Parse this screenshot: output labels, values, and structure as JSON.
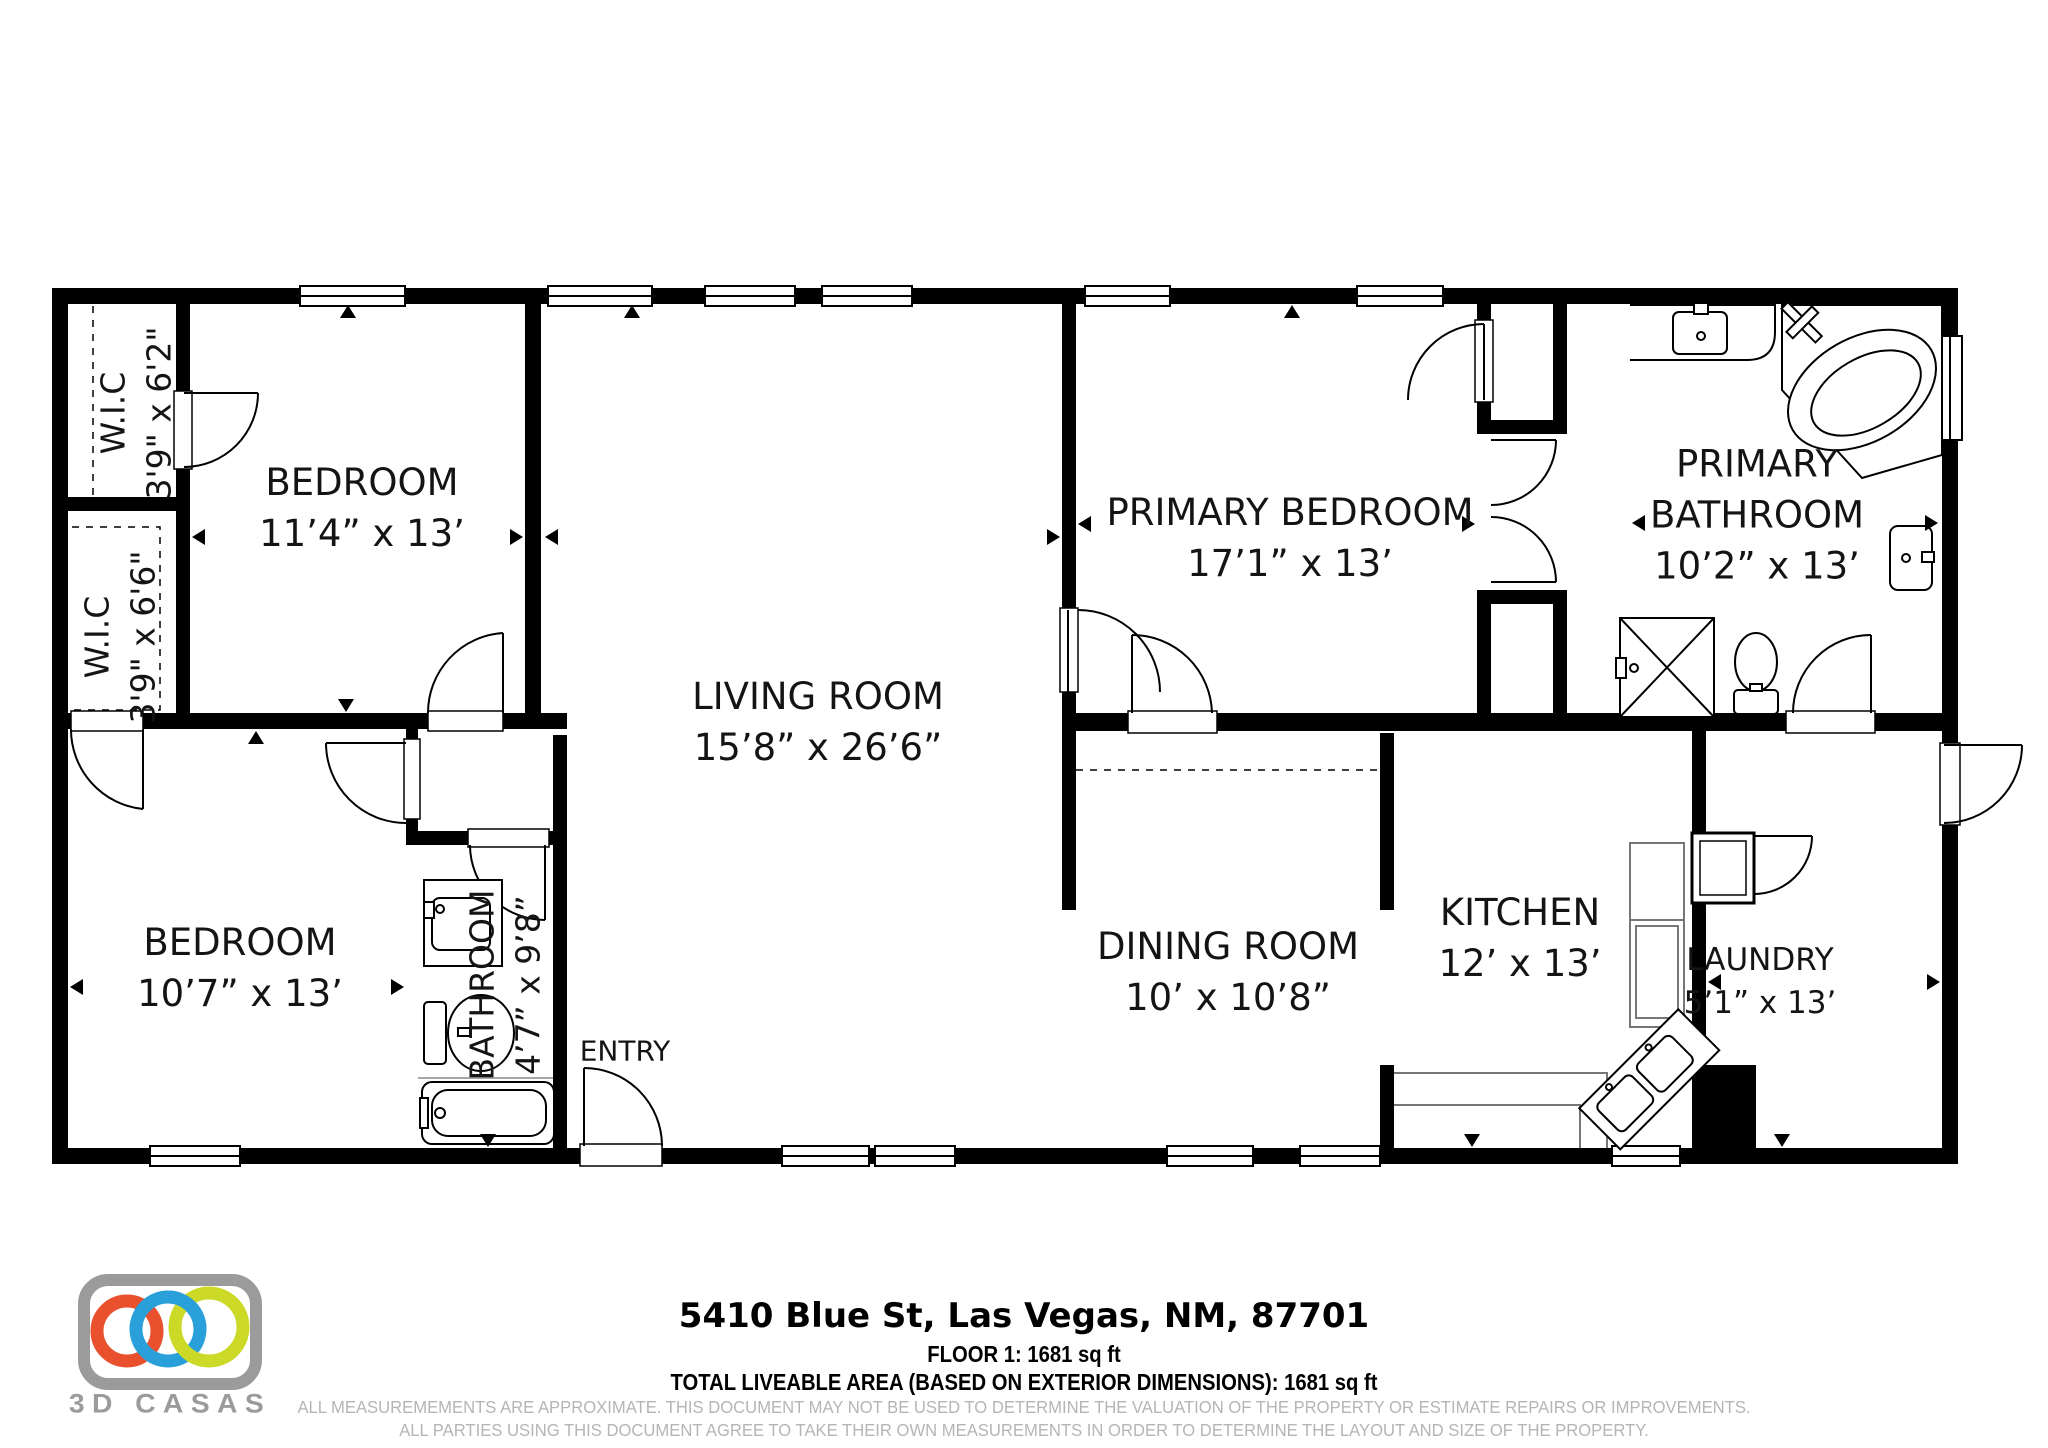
{
  "floor_plan": {
    "rooms": [
      {
        "name": "W.I.C",
        "dims": "3'9\" x 6'2\""
      },
      {
        "name": "W.I.C",
        "dims": "3'9\" x 6'6\""
      },
      {
        "name": "BEDROOM",
        "dims": "11’4” x 13’"
      },
      {
        "name": "BEDROOM",
        "dims": "10’7” x 13’"
      },
      {
        "name": "BATHROOM",
        "dims": "4’7” x 9’8”"
      },
      {
        "name": "ENTRY",
        "dims": ""
      },
      {
        "name": "LIVING ROOM",
        "dims": "15’8” x 26’6”"
      },
      {
        "name": "PRIMARY BEDROOM",
        "dims": "17’1” x 13’"
      },
      {
        "name": "PRIMARY BATHROOM",
        "dims": "10’2” x 13’"
      },
      {
        "name": "DINING ROOM",
        "dims": "10’ x 10’8”"
      },
      {
        "name": "KITCHEN",
        "dims": "12’ x 13’"
      },
      {
        "name": "LAUNDRY",
        "dims": "5’1” x 13’"
      }
    ],
    "wall_color": "#000000",
    "background": "#ffffff"
  },
  "footer": {
    "address": "5410 Blue St, Las Vegas, NM, 87701",
    "floor_line": "FLOOR 1: 1681 sq ft",
    "total_line": "TOTAL LIVEABLE AREA (BASED ON EXTERIOR DIMENSIONS): 1681 sq ft",
    "disclaimer_line1": "ALL MEASUREMEMENTS ARE APPROXIMATE. THIS DOCUMENT MAY NOT BE USED TO DETERMINE THE VALUATION OF THE PROPERTY OR ESTIMATE REPAIRS OR IMPROVEMENTS.",
    "disclaimer_line2": "ALL PARTIES USING THIS DOCUMENT AGREE TO TAKE THEIR OWN MEASUREMENTS IN ORDER TO DETERMINE THE LAYOUT AND SIZE OF THE PROPERTY."
  },
  "logo": {
    "text": "3D CASAS",
    "ring1_color": "#e8502e",
    "ring2_color": "#2aa0da",
    "ring3_color": "#ccd926",
    "frame_color": "#9b9b9b",
    "text_color": "#9b9b9b"
  }
}
